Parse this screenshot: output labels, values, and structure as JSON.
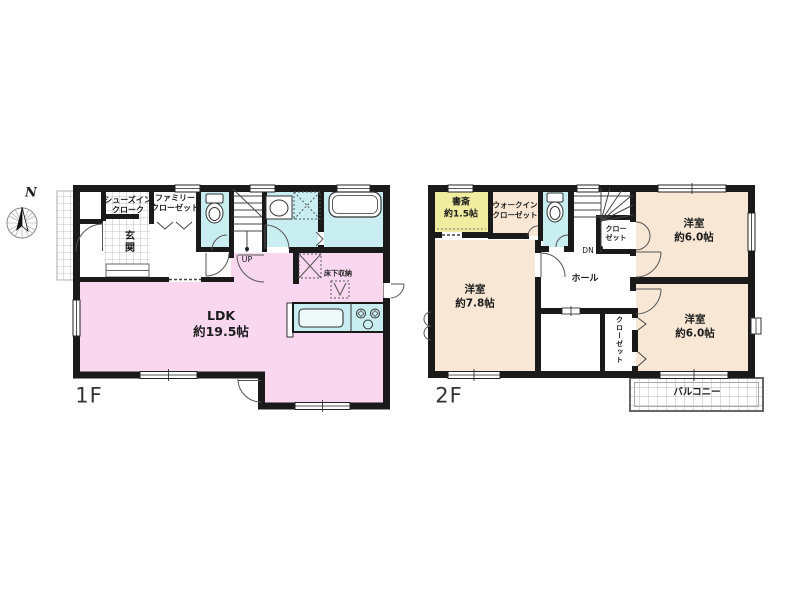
{
  "compass": {
    "north_label": "N"
  },
  "floor1": {
    "floor_label": "1F",
    "rooms": {
      "shoes_in_closet": "シューズイン\nクローク",
      "family_closet": "ファミリー\nクローゼット",
      "entrance": "玄関",
      "ldk": "LDK\n約19.5帖",
      "underfloor_storage": "床下収納"
    },
    "stairs": {
      "direction_label": "UP"
    }
  },
  "floor2": {
    "floor_label": "2F",
    "rooms": {
      "study": "書斎\n約1.5帖",
      "walk_in_closet": "ウォークイン\nクローゼット",
      "closet_upper": "クロー\nゼット",
      "bedroom_upper_right": "洋室\n約6.0帖",
      "bedroom_left": "洋室\n約7.8帖",
      "bedroom_lower_right": "洋室\n約6.0帖",
      "hall": "ホール",
      "closet_lower": "クローゼット",
      "balcony": "バルコニー"
    },
    "stairs": {
      "direction_label": "DN"
    }
  },
  "colors": {
    "ldk_pink": "#f8d7ef",
    "wet_area_cyan": "#c9eef1",
    "bedroom_beige": "#f8e7d4",
    "study_yellow": "#f0eda0",
    "wall_black": "#1a1a1a"
  }
}
